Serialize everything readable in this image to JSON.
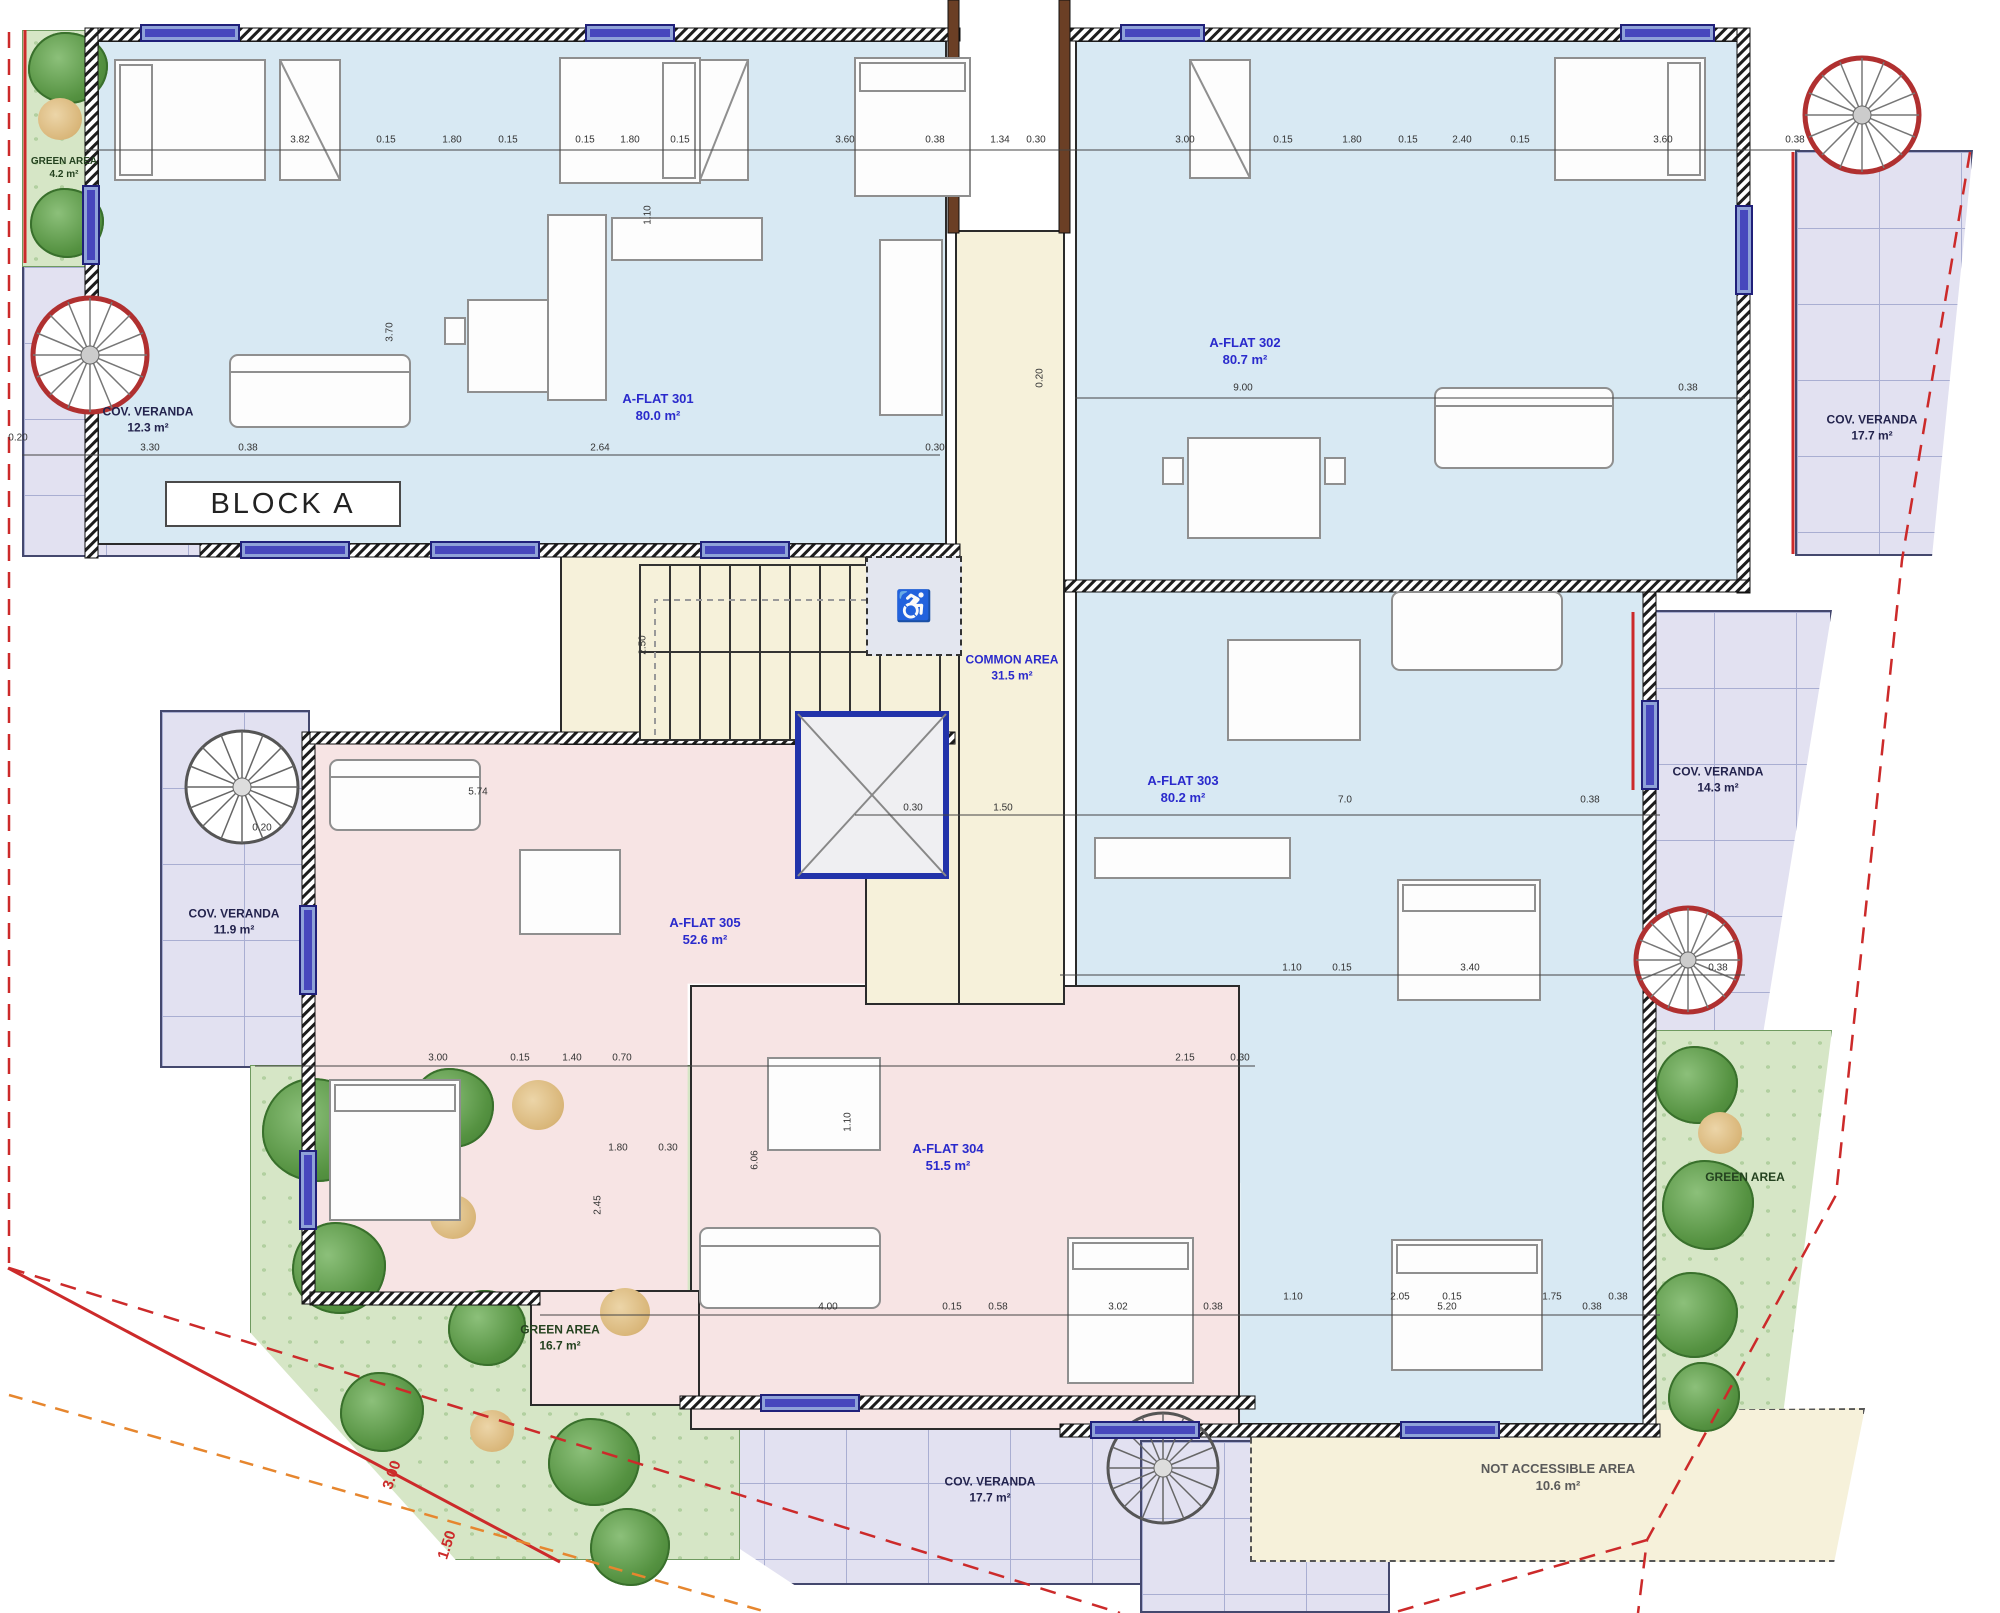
{
  "title": "BLOCK A",
  "flats": {
    "f301": {
      "name": "A-FLAT 301",
      "area": "80.0 m²"
    },
    "f302": {
      "name": "A-FLAT 302",
      "area": "80.7 m²"
    },
    "f303": {
      "name": "A-FLAT 303",
      "area": "80.2 m²"
    },
    "f304": {
      "name": "A-FLAT 304",
      "area": "51.5 m²"
    },
    "f305": {
      "name": "A-FLAT 305",
      "area": "52.6 m²"
    }
  },
  "common_area": {
    "name": "COMMON AREA",
    "area": "31.5 m²"
  },
  "verandas": {
    "top_left": {
      "name": "COV. VERANDA",
      "area": "12.3 m²"
    },
    "top_right": {
      "name": "COV. VERANDA",
      "area": "17.7 m²"
    },
    "right": {
      "name": "COV. VERANDA",
      "area": "14.3 m²"
    },
    "left": {
      "name": "COV. VERANDA",
      "area": "11.9 m²"
    },
    "bottom": {
      "name": "COV. VERANDA",
      "area": "17.7 m²"
    }
  },
  "green_areas": {
    "top_left": {
      "name": "GREEN AREA",
      "area": "4.2 m²"
    },
    "bottom_left": {
      "name": "GREEN AREA",
      "area": "16.7 m²"
    },
    "right": {
      "name": "GREEN AREA",
      "area": ""
    }
  },
  "not_accessible_area": {
    "name": "NOT ACCESSIBLE AREA",
    "area": "10.6 m²"
  },
  "colors": {
    "flat_blue": "#d8e9f3",
    "flat_pink": "#f7e4e4",
    "common_cream": "#f6f1da",
    "veranda_lavender": "#e2e1f1",
    "green_area": "#d6e6c6",
    "window_blue": "#4747bd",
    "label_blue": "#2a2acc",
    "boundary_red": "#cc2a2a",
    "boundary_orange": "#e6862e",
    "stair_red": "#b03030"
  },
  "dimension_labels": [
    {
      "t": "3.82",
      "x": 300,
      "y": 140
    },
    {
      "t": "0.15",
      "x": 386,
      "y": 140
    },
    {
      "t": "1.80",
      "x": 452,
      "y": 140
    },
    {
      "t": "0.15",
      "x": 508,
      "y": 140
    },
    {
      "t": "0.15",
      "x": 585,
      "y": 140
    },
    {
      "t": "1.80",
      "x": 630,
      "y": 140
    },
    {
      "t": "0.15",
      "x": 680,
      "y": 140
    },
    {
      "t": "3.60",
      "x": 845,
      "y": 140
    },
    {
      "t": "0.38",
      "x": 935,
      "y": 140
    },
    {
      "t": "1.34",
      "x": 1000,
      "y": 140
    },
    {
      "t": "0.30",
      "x": 1036,
      "y": 140
    },
    {
      "t": "3.00",
      "x": 1185,
      "y": 140
    },
    {
      "t": "0.15",
      "x": 1283,
      "y": 140
    },
    {
      "t": "1.80",
      "x": 1352,
      "y": 140
    },
    {
      "t": "0.15",
      "x": 1408,
      "y": 140
    },
    {
      "t": "2.40",
      "x": 1462,
      "y": 140
    },
    {
      "t": "0.15",
      "x": 1520,
      "y": 140
    },
    {
      "t": "3.60",
      "x": 1663,
      "y": 140
    },
    {
      "t": "0.38",
      "x": 1795,
      "y": 140
    },
    {
      "t": "0.20",
      "x": 18,
      "y": 438
    },
    {
      "t": "3.30",
      "x": 150,
      "y": 448
    },
    {
      "t": "0.38",
      "x": 248,
      "y": 448
    },
    {
      "t": "2.64",
      "x": 600,
      "y": 448
    },
    {
      "t": "0.30",
      "x": 935,
      "y": 448
    },
    {
      "t": "9.00",
      "x": 1243,
      "y": 388
    },
    {
      "t": "0.38",
      "x": 1688,
      "y": 388
    },
    {
      "t": "0.20",
      "x": 1040,
      "y": 378,
      "rot": true
    },
    {
      "t": "3.70",
      "x": 390,
      "y": 332,
      "rot": true
    },
    {
      "t": "1.10",
      "x": 648,
      "y": 215,
      "rot": true
    },
    {
      "t": "2.50",
      "x": 643,
      "y": 645,
      "rot": true
    },
    {
      "t": "1.50",
      "x": 1003,
      "y": 808
    },
    {
      "t": "0.30",
      "x": 913,
      "y": 808
    },
    {
      "t": "7.0",
      "x": 1345,
      "y": 800
    },
    {
      "t": "0.38",
      "x": 1590,
      "y": 800
    },
    {
      "t": "0.20",
      "x": 262,
      "y": 828
    },
    {
      "t": "5.74",
      "x": 478,
      "y": 792
    },
    {
      "t": "1.10",
      "x": 1292,
      "y": 968
    },
    {
      "t": "0.15",
      "x": 1342,
      "y": 968
    },
    {
      "t": "3.40",
      "x": 1470,
      "y": 968
    },
    {
      "t": "0.38",
      "x": 1718,
      "y": 968
    },
    {
      "t": "3.00",
      "x": 438,
      "y": 1058
    },
    {
      "t": "0.15",
      "x": 520,
      "y": 1058
    },
    {
      "t": "1.40",
      "x": 572,
      "y": 1058
    },
    {
      "t": "0.70",
      "x": 622,
      "y": 1058
    },
    {
      "t": "2.15",
      "x": 1185,
      "y": 1058
    },
    {
      "t": "0.30",
      "x": 1240,
      "y": 1058
    },
    {
      "t": "1.80",
      "x": 618,
      "y": 1148
    },
    {
      "t": "0.30",
      "x": 668,
      "y": 1148
    },
    {
      "t": "6.06",
      "x": 755,
      "y": 1160,
      "rot": true
    },
    {
      "t": "2.45",
      "x": 598,
      "y": 1205,
      "rot": true
    },
    {
      "t": "1.10",
      "x": 848,
      "y": 1122,
      "rot": true
    },
    {
      "t": "1.10",
      "x": 1293,
      "y": 1297
    },
    {
      "t": "2.05",
      "x": 1400,
      "y": 1297
    },
    {
      "t": "0.15",
      "x": 1452,
      "y": 1297
    },
    {
      "t": "1.75",
      "x": 1552,
      "y": 1297
    },
    {
      "t": "0.38",
      "x": 1618,
      "y": 1297
    },
    {
      "t": "4.00",
      "x": 828,
      "y": 1307
    },
    {
      "t": "0.15",
      "x": 952,
      "y": 1307
    },
    {
      "t": "0.58",
      "x": 998,
      "y": 1307
    },
    {
      "t": "3.02",
      "x": 1118,
      "y": 1307
    },
    {
      "t": "0.38",
      "x": 1213,
      "y": 1307
    },
    {
      "t": "5.20",
      "x": 1447,
      "y": 1307
    },
    {
      "t": "0.38",
      "x": 1592,
      "y": 1307
    },
    {
      "t": "3.00",
      "x": 392,
      "y": 1475,
      "red": true
    },
    {
      "t": "1.50",
      "x": 447,
      "y": 1545,
      "red": true
    }
  ]
}
